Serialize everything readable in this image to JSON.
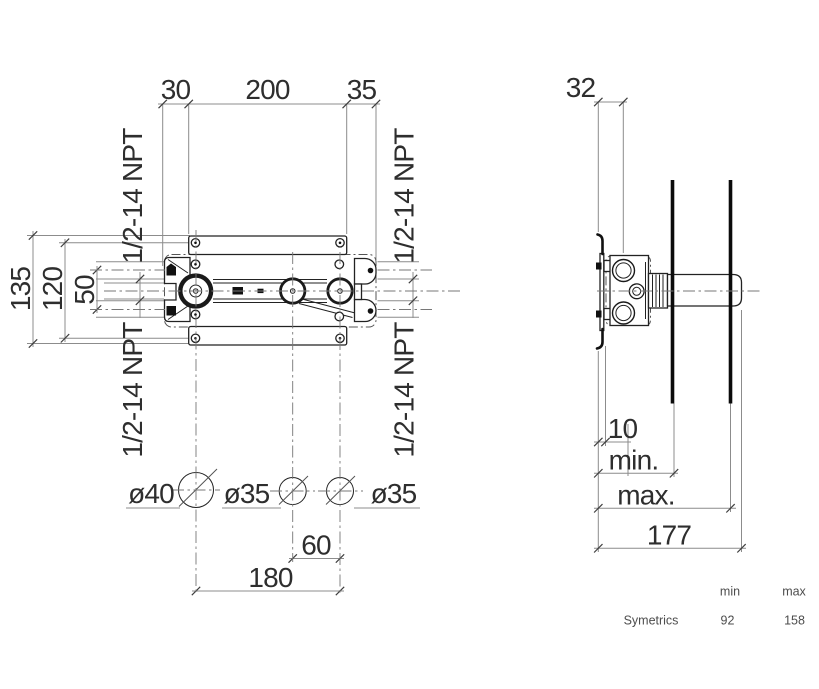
{
  "front_view": {
    "dim_top_left": "30",
    "dim_top_center": "200",
    "dim_top_right": "35",
    "dim_height_outer": "135",
    "dim_height_mid": "120",
    "dim_height_inner": "50",
    "npt_label": "1/2-14 NPT",
    "hole_left": "ø40",
    "hole_middle": "ø35",
    "hole_right": "ø35",
    "dim_spacing_inner": "60",
    "dim_spacing_outer": "180"
  },
  "side_view": {
    "dim_offset": "32",
    "dim_depth": "10",
    "label_min": "min.",
    "label_max": "max.",
    "dim_total": "177"
  },
  "table": {
    "col_min": "min",
    "col_max": "max",
    "row_label": "Symetrics",
    "value_min": "92",
    "value_max": "158"
  }
}
